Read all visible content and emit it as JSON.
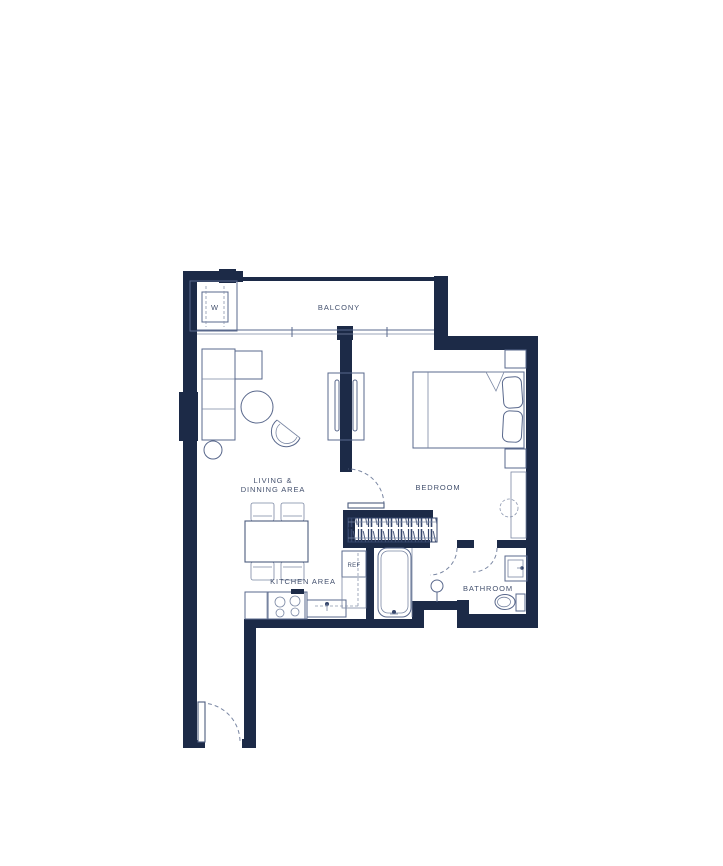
{
  "page": {
    "background": "#ffffff",
    "description": "one-bedroom apartment floor plan"
  },
  "floor_plan": {
    "labels": {
      "balcony": "BALCONY",
      "living_line1": "LIVING &",
      "living_line2": "DINNING AREA",
      "bedroom": "BEDROOM",
      "kitchen": "KITCHEN AREA",
      "bathroom": "BATHROOM",
      "refrigerator": "REF",
      "washer": "W"
    },
    "colors": {
      "wall": "#1c2a47",
      "furniture_line": "#59688c",
      "label_text": "#44516e",
      "background": "#ffffff"
    }
  }
}
